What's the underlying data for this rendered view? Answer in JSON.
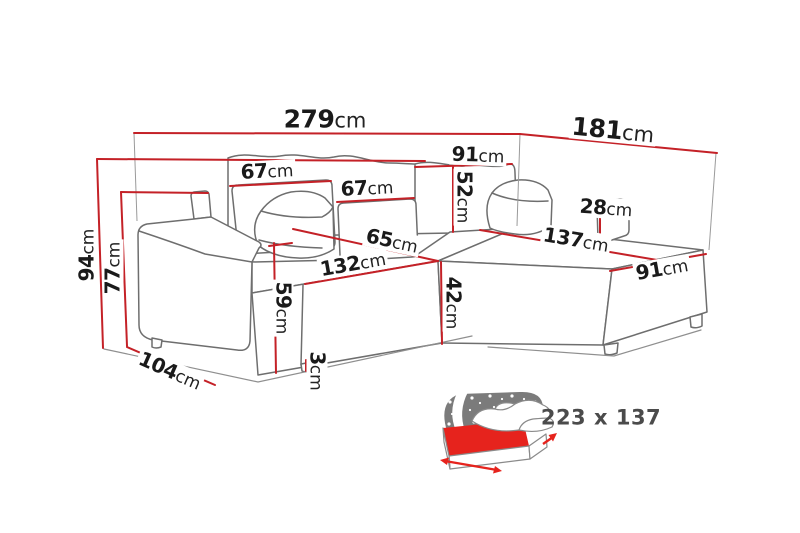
{
  "diagram": {
    "unit": "cm",
    "dims": {
      "total_length": {
        "value": "279",
        "unit": "cm"
      },
      "return_length": {
        "value": "181",
        "unit": "cm"
      },
      "back_section_width": {
        "value": "91",
        "unit": "cm"
      },
      "back_cushion_1": {
        "value": "67",
        "unit": "cm"
      },
      "back_cushion_2": {
        "value": "67",
        "unit": "cm"
      },
      "backrest_height": {
        "value": "52",
        "unit": "cm"
      },
      "right_armrest_height": {
        "value": "28",
        "unit": "cm"
      },
      "chaise_length": {
        "value": "137",
        "unit": "cm"
      },
      "chaise_width": {
        "value": "91",
        "unit": "cm"
      },
      "seat_depth": {
        "value": "65",
        "unit": "cm"
      },
      "seat_width": {
        "value": "132",
        "unit": "cm"
      },
      "total_height": {
        "value": "94",
        "unit": "cm"
      },
      "armrest_height": {
        "value": "77",
        "unit": "cm"
      },
      "seat_height": {
        "value": "59",
        "unit": "cm"
      },
      "base_height": {
        "value": "42",
        "unit": "cm"
      },
      "leg_height": {
        "value": "3",
        "unit": "cm"
      },
      "side_depth": {
        "value": "104",
        "unit": "cm"
      }
    },
    "sleeping_area": {
      "label": "223 x 137"
    },
    "colors": {
      "dimension_line": "#c42127",
      "outline": "#6e6e6e",
      "floor_line": "#8f8f8f",
      "icon_red": "#e6231d",
      "blanket_gray": "#7b7b7b",
      "label_text": "#1a1a1a",
      "size_label_text": "#4b4b4b"
    }
  }
}
